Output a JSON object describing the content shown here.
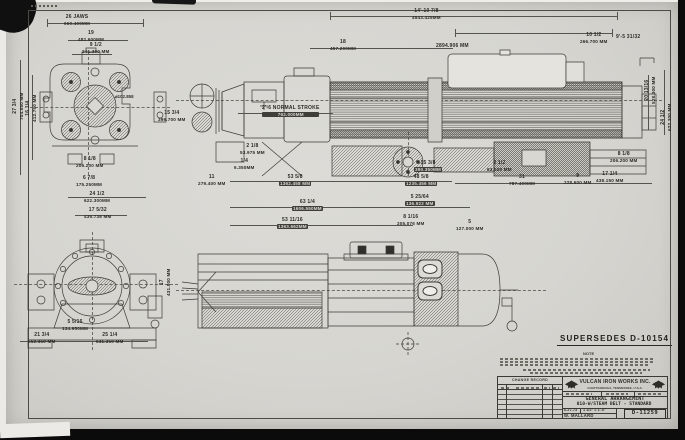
{
  "sheet": {
    "supersedes": "SUPERSEDES  D-10154",
    "note_label": "NOTE"
  },
  "labels": {
    "bore": "⌀102.858"
  },
  "title_block": {
    "company": "VULCAN IRON WORKS INC.",
    "location": "CHATTANOOGA, TENNESSEE, U.S.A.",
    "change_record_label": "CHANGE RECORD",
    "title_line1": "GENERAL ARRANGEMENT",
    "title_line2": "010-W/STEAM BELT - STANDARD",
    "date": "6-27-73",
    "scale": "1 1/2\" = 1'-0\"",
    "drawn_by": "W. MALLARD",
    "drawing_number": "D-11259"
  },
  "dims": {
    "jaws": {
      "in": "26 JAWS",
      "mm": "660.400MM"
    },
    "w19": {
      "in": "19",
      "mm": "482.600MM"
    },
    "w9h": {
      "in": "9 1/2",
      "mm": "241.300 MM"
    },
    "v27": {
      "in": "27 3/4",
      "mm": "704.850 MM"
    },
    "v16": {
      "in": "16 1/4",
      "mm": "412.750 MM"
    },
    "d206": {
      "in": "8 1/8",
      "mm": "206.200 MM"
    },
    "d175": {
      "in": "6 7/8",
      "mm": "175.250MM"
    },
    "d279": {
      "in": "11",
      "mm": "279.400 MM"
    },
    "d457": {
      "in": "18",
      "mm": "457.200MM"
    },
    "overall": {
      "in": "14'-10 7/8",
      "mm": "4543.425MM"
    },
    "d2894": {
      "in": "9'-5 31/32",
      "mm": "2894.906 MM"
    },
    "d266": {
      "in": "10 1/2",
      "mm": "266.700 MM"
    },
    "stroke": {
      "in": "2'-6 NORMAL STROKE",
      "mm": "762.000MM"
    },
    "v399": {
      "in": "15 3/4",
      "mm": "399.700 MM"
    },
    "d53975": {
      "in": "2 1/8",
      "mm": "53.975 MM"
    },
    "d6350": {
      "in": "1/4",
      "mm": "6.350MM"
    },
    "d1362": {
      "in": "53 5/8",
      "mm": "1362.458 MM"
    },
    "d390": {
      "in": "15 3/8",
      "mm": "390.350MM"
    },
    "d1235": {
      "in": "48 5/8",
      "mm": "1235.456 MM"
    },
    "d63500": {
      "in": "2 1/2",
      "mm": "63.500 MM"
    },
    "d787": {
      "in": "31",
      "mm": "787.400MM"
    },
    "d228": {
      "in": "9",
      "mm": "228.600 MM"
    },
    "d438": {
      "in": "17 1/4",
      "mm": "438.150 MM"
    },
    "d206b": {
      "in": "8 1/8",
      "mm": "206.200 MM"
    },
    "d1606": {
      "in": "63 1/4",
      "mm": "1606.550MM"
    },
    "d1363": {
      "in": "53 11/16",
      "mm": "1363.662MM"
    },
    "d136922": {
      "in": "5 25/64",
      "mm": "136.922 MM"
    },
    "d204": {
      "in": "8 1/16",
      "mm": "205.076 MM"
    },
    "d127": {
      "in": "5",
      "mm": "127.000 MM"
    },
    "d622": {
      "in": "24 1/2",
      "mm": "622.300MM"
    },
    "d435": {
      "in": "17 5/32",
      "mm": "435.738 MM"
    },
    "v431": {
      "in": "17",
      "mm": "431.800 MM"
    },
    "d552": {
      "in": "21 3/4",
      "mm": "552.450 MM"
    },
    "d641": {
      "in": "25 1/4",
      "mm": "641.350 MM"
    },
    "d134": {
      "in": "5 5/16",
      "mm": "134.950MM"
    },
    "vr528": {
      "in": "20 13/16",
      "mm": "528.300 MM"
    },
    "vr622": {
      "in": "24 1/2",
      "mm": "622.300 MM"
    }
  }
}
